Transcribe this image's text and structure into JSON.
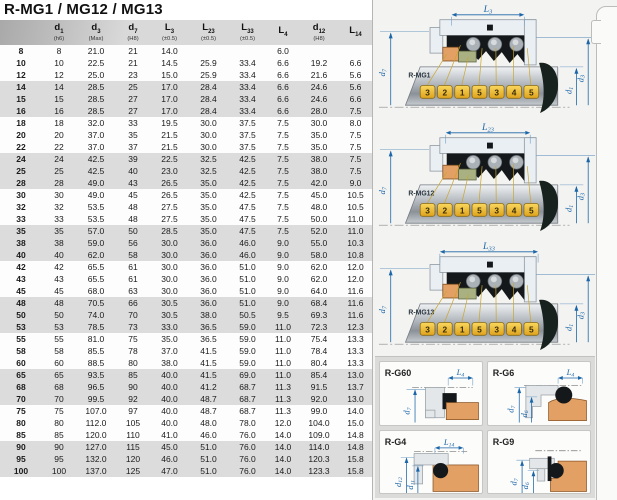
{
  "page": {
    "title": "R-MG1 / MG12 / MG13"
  },
  "colors": {
    "accent_blue": "#1b66a8",
    "callout_yellow": "#f3c33c",
    "seat_orange": "#e2a064",
    "face_green": "#a9b183",
    "housing_gray": "#eaeff4",
    "elastomer_black": "#15181a",
    "stripe_gray": "#dcdcdc"
  },
  "table": {
    "header": [
      {
        "main": "d",
        "sub": "1",
        "note": "(h6)"
      },
      {
        "main": "d",
        "sub": "3",
        "note": "(Max)"
      },
      {
        "main": "d",
        "sub": "7",
        "note": "(H8)"
      },
      {
        "main": "L",
        "sub": "3",
        "note": "(±0.5)"
      },
      {
        "main": "L",
        "sub": "23",
        "note": "(±0.5)"
      },
      {
        "main": "L",
        "sub": "33",
        "note": "(±0.5)"
      },
      {
        "main": "L",
        "sub": "4",
        "note": ""
      },
      {
        "main": "d",
        "sub": "12",
        "note": "(H8)"
      },
      {
        "main": "L",
        "sub": "14",
        "note": ""
      }
    ],
    "rows": [
      {
        "label": "8",
        "values": [
          "8",
          "21.0",
          "21",
          "14.0",
          "",
          "",
          "6.0",
          "",
          ""
        ]
      },
      {
        "label": "10",
        "values": [
          "10",
          "22.5",
          "21",
          "14.5",
          "25.9",
          "33.4",
          "6.6",
          "19.2",
          "6.6"
        ]
      },
      {
        "label": "12",
        "values": [
          "12",
          "25.0",
          "23",
          "15.0",
          "25.9",
          "33.4",
          "6.6",
          "21.6",
          "5.6"
        ]
      },
      {
        "label": "14",
        "values": [
          "14",
          "28.5",
          "25",
          "17.0",
          "28.4",
          "33.4",
          "6.6",
          "24.6",
          "5.6"
        ]
      },
      {
        "label": "15",
        "values": [
          "15",
          "28.5",
          "27",
          "17.0",
          "28.4",
          "33.4",
          "6.6",
          "24.6",
          "6.6"
        ]
      },
      {
        "label": "16",
        "values": [
          "16",
          "28.5",
          "27",
          "17.0",
          "28.4",
          "33.4",
          "6.6",
          "28.0",
          "7.5"
        ]
      },
      {
        "label": "18",
        "values": [
          "18",
          "32.0",
          "33",
          "19.5",
          "30.0",
          "37.5",
          "7.5",
          "30.0",
          "8.0"
        ]
      },
      {
        "label": "20",
        "values": [
          "20",
          "37.0",
          "35",
          "21.5",
          "30.0",
          "37.5",
          "7.5",
          "35.0",
          "7.5"
        ]
      },
      {
        "label": "22",
        "values": [
          "22",
          "37.0",
          "37",
          "21.5",
          "30.0",
          "37.5",
          "7.5",
          "35.0",
          "7.5"
        ]
      },
      {
        "label": "24",
        "values": [
          "24",
          "42.5",
          "39",
          "22.5",
          "32.5",
          "42.5",
          "7.5",
          "38.0",
          "7.5"
        ]
      },
      {
        "label": "25",
        "values": [
          "25",
          "42.5",
          "40",
          "23.0",
          "32.5",
          "42.5",
          "7.5",
          "38.0",
          "7.5"
        ]
      },
      {
        "label": "28",
        "values": [
          "28",
          "49.0",
          "43",
          "26.5",
          "35.0",
          "42.5",
          "7.5",
          "42.0",
          "9.0"
        ]
      },
      {
        "label": "30",
        "values": [
          "30",
          "49.0",
          "45",
          "26.5",
          "35.0",
          "42.5",
          "7.5",
          "45.0",
          "10.5"
        ]
      },
      {
        "label": "32",
        "values": [
          "32",
          "53.5",
          "48",
          "27.5",
          "35.0",
          "47.5",
          "7.5",
          "48.0",
          "10.5"
        ]
      },
      {
        "label": "33",
        "values": [
          "33",
          "53.5",
          "48",
          "27.5",
          "35.0",
          "47.5",
          "7.5",
          "50.0",
          "11.0"
        ]
      },
      {
        "label": "35",
        "values": [
          "35",
          "57.0",
          "50",
          "28.5",
          "35.0",
          "47.5",
          "7.5",
          "52.0",
          "11.0"
        ]
      },
      {
        "label": "38",
        "values": [
          "38",
          "59.0",
          "56",
          "30.0",
          "36.0",
          "46.0",
          "9.0",
          "55.0",
          "10.3"
        ]
      },
      {
        "label": "40",
        "values": [
          "40",
          "62.0",
          "58",
          "30.0",
          "36.0",
          "46.0",
          "9.0",
          "58.0",
          "10.8"
        ]
      },
      {
        "label": "42",
        "values": [
          "42",
          "65.5",
          "61",
          "30.0",
          "36.0",
          "51.0",
          "9.0",
          "62.0",
          "12.0"
        ]
      },
      {
        "label": "43",
        "values": [
          "43",
          "65.5",
          "61",
          "30.0",
          "36.0",
          "51.0",
          "9.0",
          "62.0",
          "12.0"
        ]
      },
      {
        "label": "45",
        "values": [
          "45",
          "68.0",
          "63",
          "30.0",
          "36.0",
          "51.0",
          "9.0",
          "64.0",
          "11.6"
        ]
      },
      {
        "label": "48",
        "values": [
          "48",
          "70.5",
          "66",
          "30.5",
          "36.0",
          "51.0",
          "9.0",
          "68.4",
          "11.6"
        ]
      },
      {
        "label": "50",
        "values": [
          "50",
          "74.0",
          "70",
          "30.5",
          "38.0",
          "50.5",
          "9.5",
          "69.3",
          "11.6"
        ]
      },
      {
        "label": "53",
        "values": [
          "53",
          "78.5",
          "73",
          "33.0",
          "36.5",
          "59.0",
          "11.0",
          "72.3",
          "12.3"
        ]
      },
      {
        "label": "55",
        "values": [
          "55",
          "81.0",
          "75",
          "35.0",
          "36.5",
          "59.0",
          "11.0",
          "75.4",
          "13.3"
        ]
      },
      {
        "label": "58",
        "values": [
          "58",
          "85.5",
          "78",
          "37.0",
          "41.5",
          "59.0",
          "11.0",
          "78.4",
          "13.3"
        ]
      },
      {
        "label": "60",
        "values": [
          "60",
          "88.5",
          "80",
          "38.0",
          "41.5",
          "59.0",
          "11.0",
          "80.4",
          "13.3"
        ]
      },
      {
        "label": "65",
        "values": [
          "65",
          "93.5",
          "85",
          "40.0",
          "41.5",
          "69.0",
          "11.0",
          "85.4",
          "13.0"
        ]
      },
      {
        "label": "68",
        "values": [
          "68",
          "96.5",
          "90",
          "40.0",
          "41.2",
          "68.7",
          "11.3",
          "91.5",
          "13.7"
        ]
      },
      {
        "label": "70",
        "values": [
          "70",
          "99.5",
          "92",
          "40.0",
          "48.7",
          "68.7",
          "11.3",
          "92.0",
          "13.0"
        ]
      },
      {
        "label": "75",
        "values": [
          "75",
          "107.0",
          "97",
          "40.0",
          "48.7",
          "68.7",
          "11.3",
          "99.0",
          "14.0"
        ]
      },
      {
        "label": "80",
        "values": [
          "80",
          "112.0",
          "105",
          "40.0",
          "48.0",
          "78.0",
          "12.0",
          "104.0",
          "15.0"
        ]
      },
      {
        "label": "85",
        "values": [
          "85",
          "120.0",
          "110",
          "41.0",
          "46.0",
          "76.0",
          "14.0",
          "109.0",
          "14.8"
        ]
      },
      {
        "label": "90",
        "values": [
          "90",
          "127.0",
          "115",
          "45.0",
          "51.0",
          "76.0",
          "14.0",
          "114.0",
          "14.8"
        ]
      },
      {
        "label": "95",
        "values": [
          "95",
          "132.0",
          "120",
          "46.0",
          "51.0",
          "76.0",
          "14.0",
          "120.3",
          "15.8"
        ]
      },
      {
        "label": "100",
        "values": [
          "100",
          "137.0",
          "125",
          "47.0",
          "51.0",
          "76.0",
          "14.0",
          "123.3",
          "15.8"
        ]
      }
    ]
  },
  "diagrams": [
    {
      "id": "R-MG1",
      "length_dim": {
        "main": "L",
        "sub": "3"
      },
      "bore_dim": {
        "main": "d",
        "sub": "7"
      },
      "shaft_dim": {
        "main": "d",
        "sub": "1"
      },
      "outer_dim": {
        "main": "d",
        "sub": "3"
      },
      "callouts": [
        "3",
        "2",
        "1",
        "5",
        "3",
        "4",
        "5"
      ]
    },
    {
      "id": "R-MG12",
      "length_dim": {
        "main": "L",
        "sub": "23"
      },
      "bore_dim": {
        "main": "d",
        "sub": "7"
      },
      "shaft_dim": {
        "main": "d",
        "sub": "1"
      },
      "outer_dim": {
        "main": "d",
        "sub": "3"
      },
      "callouts": [
        "3",
        "2",
        "1",
        "5",
        "3",
        "4",
        "5"
      ]
    },
    {
      "id": "R-MG13",
      "length_dim": {
        "main": "L",
        "sub": "33"
      },
      "bore_dim": {
        "main": "d",
        "sub": "7"
      },
      "shaft_dim": {
        "main": "d",
        "sub": "1"
      },
      "outer_dim": {
        "main": "d",
        "sub": "3"
      },
      "callouts": [
        "3",
        "2",
        "1",
        "5",
        "3",
        "4",
        "5"
      ]
    }
  ],
  "seat_diagrams": [
    {
      "id": "R-G60",
      "width_dim": {
        "main": "L",
        "sub": "4"
      },
      "dims": [
        {
          "main": "d",
          "sub": "7"
        }
      ]
    },
    {
      "id": "R-G6",
      "width_dim": {
        "main": "L",
        "sub": "4"
      },
      "dims": [
        {
          "main": "d",
          "sub": "7"
        },
        {
          "main": "d",
          "sub": "6"
        }
      ]
    },
    {
      "id": "R-G4",
      "width_dim": {
        "main": "L",
        "sub": "14"
      },
      "dims": [
        {
          "main": "d",
          "sub": "12"
        },
        {
          "main": "d",
          "sub": "11"
        }
      ]
    },
    {
      "id": "R-G9",
      "width_dim": null,
      "dims": [
        {
          "main": "d",
          "sub": "7"
        },
        {
          "main": "d",
          "sub": "6"
        }
      ]
    }
  ]
}
